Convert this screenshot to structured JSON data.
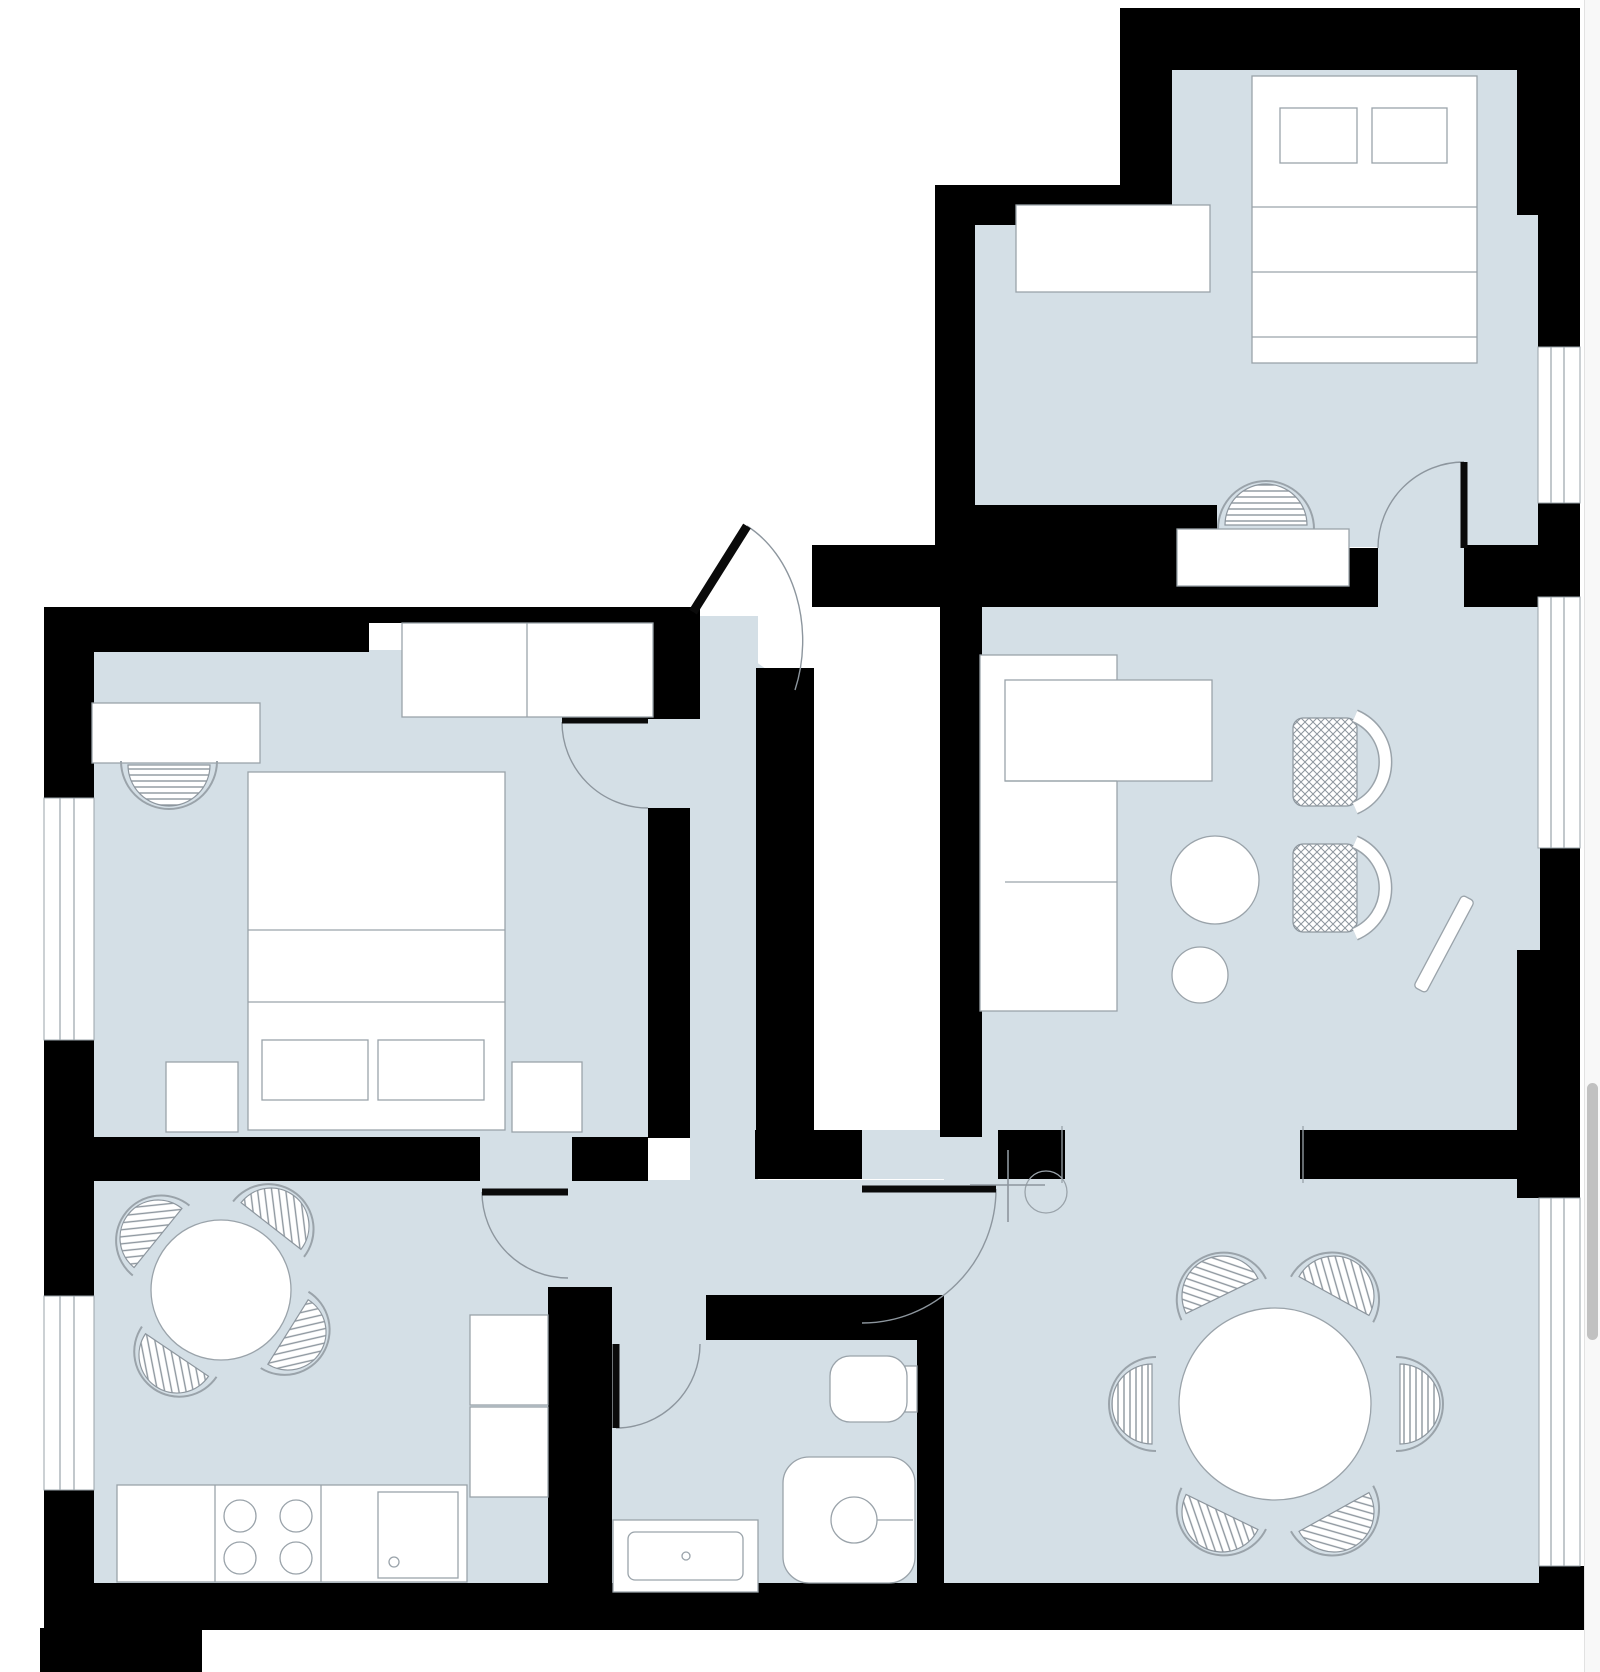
{
  "meta": {
    "title": "apartment-floor-plan",
    "canvas": {
      "width": 1600,
      "height": 1672
    }
  },
  "colors": {
    "wall": "#000000",
    "floor": "#d4dfe6",
    "furniture_fill": "#ffffff",
    "furniture_stroke": "#9aa3aa",
    "hatch": "#8d969e",
    "arc": "#8d969e",
    "leaf": "#0a0a0a",
    "glass_line": "#9aa3aa",
    "scroll_track": "#f8f8f8",
    "scroll_thumb": "#c1c1c1"
  },
  "scrollbar": {
    "thumb_top": 1083,
    "thumb_height": 257
  },
  "floors": [
    {
      "name": "floor-bedroom2-upper",
      "x": 1172,
      "y": 70,
      "w": 345,
      "h": 158
    },
    {
      "name": "floor-bedroom2-right-strip",
      "x": 1517,
      "y": 212,
      "w": 21,
      "h": 135
    },
    {
      "name": "floor-bedroom2-main",
      "x": 975,
      "y": 223,
      "w": 563,
      "h": 284
    },
    {
      "name": "floor-bedroom2-lower-strip",
      "x": 1215,
      "y": 505,
      "w": 323,
      "h": 42
    },
    {
      "name": "floor-bedroom2-door-gap",
      "x": 1378,
      "y": 545,
      "w": 88,
      "h": 62
    },
    {
      "name": "floor-living-notch",
      "x": 940,
      "y": 560,
      "w": 62,
      "h": 46
    },
    {
      "name": "floor-living-room",
      "x": 980,
      "y": 605,
      "w": 560,
      "h": 527
    },
    {
      "name": "floor-living-dining-opening",
      "x": 1065,
      "y": 1130,
      "w": 235,
      "h": 49
    },
    {
      "name": "floor-dining-door-gap",
      "x": 860,
      "y": 1130,
      "w": 140,
      "h": 49
    },
    {
      "name": "floor-dining-room",
      "x": 944,
      "y": 1177,
      "w": 596,
      "h": 407
    },
    {
      "name": "floor-hallway",
      "x": 690,
      "y": 616,
      "w": 68,
      "h": 679
    },
    {
      "name": "floor-hall-lower",
      "x": 552,
      "y": 1180,
      "w": 392,
      "h": 161
    },
    {
      "name": "floor-kitchen",
      "x": 94,
      "y": 1180,
      "w": 458,
      "h": 404
    },
    {
      "name": "floor-bedroom1",
      "x": 94,
      "y": 650,
      "w": 556,
      "h": 488
    },
    {
      "name": "floor-bathroom",
      "x": 612,
      "y": 1340,
      "w": 305,
      "h": 244
    },
    {
      "name": "floor-kitchen-door-gap",
      "x": 480,
      "y": 1137,
      "w": 92,
      "h": 44
    },
    {
      "name": "floor-bedroom1-door-gap",
      "x": 648,
      "y": 719,
      "w": 42,
      "h": 90
    }
  ],
  "floor_polygons": [
    {
      "name": "floor-entry-triangle",
      "points": "690,614 795,690 690,690"
    }
  ],
  "walls": [
    {
      "name": "wall-top",
      "x": 1120,
      "y": 8,
      "w": 460,
      "h": 62
    },
    {
      "name": "wall-bedroom2-left-upper",
      "x": 1120,
      "y": 8,
      "w": 52,
      "h": 180
    },
    {
      "name": "wall-bedroom2-step",
      "x": 935,
      "y": 185,
      "w": 237,
      "h": 40
    },
    {
      "name": "wall-bedroom2-left",
      "x": 935,
      "y": 185,
      "w": 40,
      "h": 360
    },
    {
      "name": "wall-bedroom2-bottom",
      "x": 935,
      "y": 505,
      "w": 282,
      "h": 48
    },
    {
      "name": "wall-entry-top",
      "x": 812,
      "y": 545,
      "w": 132,
      "h": 62
    },
    {
      "name": "wall-living-top",
      "x": 942,
      "y": 548,
      "w": 436,
      "h": 59
    },
    {
      "name": "wall-living-top-stub",
      "x": 1464,
      "y": 545,
      "w": 76,
      "h": 62
    },
    {
      "name": "wall-living-left",
      "x": 940,
      "y": 605,
      "w": 42,
      "h": 532
    },
    {
      "name": "wall-entry-right",
      "x": 756,
      "y": 668,
      "w": 58,
      "h": 469
    },
    {
      "name": "wall-right-top-corner",
      "x": 1517,
      "y": 70,
      "w": 63,
      "h": 145
    },
    {
      "name": "wall-right-1",
      "x": 1538,
      "y": 215,
      "w": 42,
      "h": 132
    },
    {
      "name": "wall-right-2",
      "x": 1538,
      "y": 503,
      "w": 42,
      "h": 94
    },
    {
      "name": "wall-right-3",
      "x": 1540,
      "y": 848,
      "w": 40,
      "h": 104
    },
    {
      "name": "wall-right-pillar",
      "x": 1517,
      "y": 950,
      "w": 63,
      "h": 248
    },
    {
      "name": "wall-bottom-right-corner",
      "x": 1539,
      "y": 1566,
      "w": 45,
      "h": 64
    },
    {
      "name": "wall-dining-top-left",
      "x": 755,
      "y": 1130,
      "w": 107,
      "h": 49
    },
    {
      "name": "wall-dining-top-mid",
      "x": 998,
      "y": 1130,
      "w": 67,
      "h": 49
    },
    {
      "name": "wall-dining-top-right",
      "x": 1300,
      "y": 1130,
      "w": 240,
      "h": 49
    },
    {
      "name": "wall-bedroom1-top",
      "x": 44,
      "y": 607,
      "w": 325,
      "h": 45
    },
    {
      "name": "wall-wardrobe-back",
      "x": 367,
      "y": 607,
      "w": 286,
      "h": 16
    },
    {
      "name": "wall-bedroom1-door-block",
      "x": 648,
      "y": 607,
      "w": 52,
      "h": 112
    },
    {
      "name": "wall-bedroom1-right",
      "x": 648,
      "y": 808,
      "w": 42,
      "h": 330
    },
    {
      "name": "wall-left-upper",
      "x": 44,
      "y": 607,
      "w": 50,
      "h": 191
    },
    {
      "name": "wall-left-mid",
      "x": 44,
      "y": 1040,
      "w": 50,
      "h": 256
    },
    {
      "name": "wall-left-lower",
      "x": 44,
      "y": 1490,
      "w": 50,
      "h": 140
    },
    {
      "name": "wall-bedroom1-kitchen-a",
      "x": 44,
      "y": 1137,
      "w": 436,
      "h": 44
    },
    {
      "name": "wall-bedroom1-kitchen-b",
      "x": 572,
      "y": 1137,
      "w": 76,
      "h": 44
    },
    {
      "name": "wall-kitchen-bath",
      "x": 548,
      "y": 1287,
      "w": 64,
      "h": 343
    },
    {
      "name": "wall-bath-top",
      "x": 706,
      "y": 1295,
      "w": 211,
      "h": 45
    },
    {
      "name": "wall-bath-right",
      "x": 917,
      "y": 1295,
      "w": 27,
      "h": 335
    },
    {
      "name": "wall-bottom",
      "x": 44,
      "y": 1583,
      "w": 1536,
      "h": 47
    },
    {
      "name": "wall-bottom-left-step",
      "x": 40,
      "y": 1628,
      "w": 162,
      "h": 44
    }
  ],
  "windows": [
    {
      "name": "window-bedroom1",
      "x": 44,
      "y": 798,
      "w": 50,
      "h": 242,
      "lines_x": [
        60,
        74
      ]
    },
    {
      "name": "window-kitchen",
      "x": 44,
      "y": 1296,
      "w": 50,
      "h": 194,
      "lines_x": [
        60,
        74
      ]
    },
    {
      "name": "window-bedroom2",
      "x": 1538,
      "y": 347,
      "w": 42,
      "h": 156,
      "lines_x": [
        1551,
        1564
      ]
    },
    {
      "name": "window-living",
      "x": 1538,
      "y": 597,
      "w": 42,
      "h": 251,
      "lines_x": [
        1551,
        1564
      ]
    },
    {
      "name": "window-dining",
      "x": 1539,
      "y": 1198,
      "w": 41,
      "h": 368,
      "lines_x": [
        1551,
        1564
      ]
    }
  ],
  "furniture_rects": [
    {
      "name": "wardrobe-bedroom1",
      "x": 402,
      "y": 623,
      "w": 251,
      "h": 94
    },
    {
      "name": "desk-bedroom1",
      "x": 92,
      "y": 703,
      "w": 168,
      "h": 60
    },
    {
      "name": "bed-bedroom1",
      "x": 248,
      "y": 772,
      "w": 257,
      "h": 358
    },
    {
      "name": "pillow-bedroom1-a",
      "x": 262,
      "y": 1040,
      "w": 106,
      "h": 60
    },
    {
      "name": "pillow-bedroom1-b",
      "x": 378,
      "y": 1040,
      "w": 106,
      "h": 60
    },
    {
      "name": "nightstand-left",
      "x": 166,
      "y": 1062,
      "w": 72,
      "h": 70
    },
    {
      "name": "nightstand-right",
      "x": 512,
      "y": 1062,
      "w": 70,
      "h": 70
    },
    {
      "name": "wardrobe-bedroom2",
      "x": 1016,
      "y": 205,
      "w": 194,
      "h": 87
    },
    {
      "name": "bed-bedroom2",
      "x": 1252,
      "y": 76,
      "w": 225,
      "h": 287
    },
    {
      "name": "pillow-bedroom2-a",
      "x": 1280,
      "y": 108,
      "w": 77,
      "h": 55
    },
    {
      "name": "pillow-bedroom2-b",
      "x": 1372,
      "y": 108,
      "w": 75,
      "h": 55
    },
    {
      "name": "desk-bedroom2",
      "x": 1177,
      "y": 529,
      "w": 172,
      "h": 57
    },
    {
      "name": "sofa-body",
      "x": 980,
      "y": 655,
      "w": 137,
      "h": 356
    },
    {
      "name": "sofa-chaise",
      "x": 1005,
      "y": 680,
      "w": 207,
      "h": 101
    },
    {
      "name": "kitchen-counter",
      "x": 117,
      "y": 1485,
      "w": 350,
      "h": 97
    },
    {
      "name": "kitchen-appliance",
      "x": 378,
      "y": 1492,
      "w": 80,
      "h": 86
    },
    {
      "name": "kitchen-unit-a",
      "x": 470,
      "y": 1315,
      "w": 78,
      "h": 90
    },
    {
      "name": "kitchen-unit-b",
      "x": 470,
      "y": 1407,
      "w": 78,
      "h": 90
    },
    {
      "name": "toilet-tank",
      "x": 905,
      "y": 1366,
      "w": 12,
      "h": 46
    },
    {
      "name": "sink-bathroom",
      "x": 613,
      "y": 1520,
      "w": 145,
      "h": 72
    }
  ],
  "furniture_round_rects": [
    {
      "name": "toilet-bowl",
      "x": 830,
      "y": 1356,
      "w": 77,
      "h": 66,
      "rx": 20
    },
    {
      "name": "shower-tray",
      "x": 783,
      "y": 1457,
      "w": 132,
      "h": 126,
      "rx": 26
    },
    {
      "name": "sink-basin",
      "x": 628,
      "y": 1532,
      "w": 115,
      "h": 48,
      "rx": 7
    }
  ],
  "furniture_circles": [
    {
      "name": "coffee-table-large",
      "cx": 1215,
      "cy": 880,
      "r": 44,
      "fill": true
    },
    {
      "name": "coffee-table-small",
      "cx": 1200,
      "cy": 975,
      "r": 28,
      "fill": true
    },
    {
      "name": "kitchen-table",
      "cx": 221,
      "cy": 1290,
      "r": 70,
      "fill": true
    },
    {
      "name": "dining-table",
      "cx": 1275,
      "cy": 1404,
      "r": 96,
      "fill": true
    },
    {
      "name": "stove-burner-1",
      "cx": 240,
      "cy": 1516,
      "r": 16,
      "fill": false
    },
    {
      "name": "stove-burner-2",
      "cx": 296,
      "cy": 1516,
      "r": 16,
      "fill": false
    },
    {
      "name": "stove-burner-3",
      "cx": 240,
      "cy": 1558,
      "r": 16,
      "fill": false
    },
    {
      "name": "stove-burner-4",
      "cx": 296,
      "cy": 1558,
      "r": 16,
      "fill": false
    },
    {
      "name": "appliance-knob",
      "cx": 394,
      "cy": 1562,
      "r": 5,
      "fill": false
    },
    {
      "name": "shower-drain",
      "cx": 854,
      "cy": 1520,
      "r": 23,
      "fill": false
    },
    {
      "name": "sink-faucet-dot",
      "cx": 686,
      "cy": 1556,
      "r": 4,
      "fill": false
    },
    {
      "name": "lamp-shade",
      "cx": 1046,
      "cy": 1192,
      "r": 21,
      "fill": false
    }
  ],
  "detail_lines": [
    {
      "name": "bed1-fold-1",
      "x1": 248,
      "y1": 930,
      "x2": 505,
      "y2": 930
    },
    {
      "name": "bed1-fold-2",
      "x1": 248,
      "y1": 1002,
      "x2": 505,
      "y2": 1002
    },
    {
      "name": "wardrobe1-divider",
      "x1": 527,
      "y1": 623,
      "x2": 527,
      "y2": 717
    },
    {
      "name": "bed2-fold-1",
      "x1": 1252,
      "y1": 207,
      "x2": 1477,
      "y2": 207
    },
    {
      "name": "bed2-fold-2",
      "x1": 1252,
      "y1": 272,
      "x2": 1477,
      "y2": 272
    },
    {
      "name": "bed2-fold-3",
      "x1": 1252,
      "y1": 337,
      "x2": 1477,
      "y2": 337
    },
    {
      "name": "sofa-seam-1",
      "x1": 1005,
      "y1": 781,
      "x2": 1117,
      "y2": 781
    },
    {
      "name": "sofa-seam-2",
      "x1": 1005,
      "y1": 882,
      "x2": 1117,
      "y2": 882
    },
    {
      "name": "counter-divider-1",
      "x1": 215,
      "y1": 1485,
      "x2": 215,
      "y2": 1582
    },
    {
      "name": "counter-divider-2",
      "x1": 321,
      "y1": 1485,
      "x2": 321,
      "y2": 1582
    },
    {
      "name": "opening-jamb-left",
      "x1": 1062,
      "y1": 1126,
      "x2": 1062,
      "y2": 1183
    },
    {
      "name": "opening-jamb-right",
      "x1": 1303,
      "y1": 1126,
      "x2": 1303,
      "y2": 1183
    },
    {
      "name": "shower-handle",
      "x1": 877,
      "y1": 1520,
      "x2": 913,
      "y2": 1520
    }
  ],
  "lamp_lines": [
    {
      "name": "lamp-arm-h",
      "x1": 970,
      "y1": 1185,
      "x2": 1045,
      "y2": 1185
    },
    {
      "name": "lamp-arm-v",
      "x1": 1008,
      "y1": 1150,
      "x2": 1008,
      "y2": 1222
    }
  ],
  "mirror": {
    "name": "mirror-leaning",
    "cx": 1444,
    "cy": 944,
    "length": 104,
    "width": 14,
    "angle": -62
  },
  "chairs": [
    {
      "name": "desk-chair-bedroom1",
      "cx": 169,
      "cy": 765,
      "r": 41,
      "rot": 180,
      "pattern": "stripe"
    },
    {
      "name": "desk-chair-bedroom2",
      "cx": 1266,
      "cy": 525,
      "r": 41,
      "rot": 0,
      "pattern": "stripe"
    },
    {
      "name": "dining-chair-1",
      "cx": 1222,
      "cy": 1296,
      "r": 40,
      "rot": -26,
      "pattern": "diag"
    },
    {
      "name": "dining-chair-2",
      "cx": 1334,
      "cy": 1296,
      "r": 40,
      "rot": 29,
      "pattern": "diag"
    },
    {
      "name": "dining-chair-3",
      "cx": 1152,
      "cy": 1404,
      "r": 40,
      "rot": 270,
      "pattern": "stripe"
    },
    {
      "name": "dining-chair-4",
      "cx": 1400,
      "cy": 1404,
      "r": 40,
      "rot": 90,
      "pattern": "stripe"
    },
    {
      "name": "dining-chair-5",
      "cx": 1222,
      "cy": 1512,
      "r": 40,
      "rot": 206,
      "pattern": "diag"
    },
    {
      "name": "dining-chair-6",
      "cx": 1334,
      "cy": 1512,
      "r": 40,
      "rot": 151,
      "pattern": "diag"
    },
    {
      "name": "kitchen-chair-1",
      "cx": 271,
      "cy": 1226,
      "r": 38,
      "rot": 38,
      "pattern": "diag"
    },
    {
      "name": "kitchen-chair-2",
      "cx": 158,
      "cy": 1238,
      "r": 38,
      "rot": -51,
      "pattern": "diag"
    },
    {
      "name": "kitchen-chair-3",
      "cx": 177,
      "cy": 1355,
      "r": 38,
      "rot": 214,
      "pattern": "diag"
    },
    {
      "name": "kitchen-chair-4",
      "cx": 288,
      "cy": 1332,
      "r": 38,
      "rot": 122,
      "pattern": "diag"
    }
  ],
  "armchairs": [
    {
      "name": "armchair-1",
      "cx": 1337,
      "cy": 762
    },
    {
      "name": "armchair-2",
      "cx": 1337,
      "cy": 888
    }
  ],
  "door_arcs": [
    {
      "name": "arc-entry-door",
      "d": "M 747,526 A 100,128 0 0 1 795,690"
    },
    {
      "name": "arc-bedroom1-door",
      "d": "M 562,722 A 86,86 0 0 0 648,808"
    },
    {
      "name": "arc-bedroom2-door",
      "d": "M 1464,462 A 86,86 0 0 0 1378,548"
    },
    {
      "name": "arc-kitchen-door",
      "d": "M 482,1192 A 86,86 0 0 0 568,1278"
    },
    {
      "name": "arc-dining-door",
      "d": "M 996,1189 A 134,134 0 0 1 862,1323"
    },
    {
      "name": "arc-bathroom-door",
      "d": "M 616,1428 A 84,84 0 0 0 700,1344"
    }
  ],
  "door_leaves": [
    {
      "name": "leaf-entry-door",
      "x1": 693,
      "y1": 612,
      "x2": 747,
      "y2": 526,
      "w": 9
    },
    {
      "name": "leaf-bedroom1-door",
      "x1": 562,
      "y1": 720,
      "x2": 648,
      "y2": 720,
      "w": 7
    },
    {
      "name": "leaf-bedroom2-door",
      "x1": 1464,
      "y1": 462,
      "x2": 1464,
      "y2": 548,
      "w": 7
    },
    {
      "name": "leaf-kitchen-door",
      "x1": 482,
      "y1": 1192,
      "x2": 568,
      "y2": 1192,
      "w": 7
    },
    {
      "name": "leaf-dining-door",
      "x1": 862,
      "y1": 1189,
      "x2": 996,
      "y2": 1189,
      "w": 7
    },
    {
      "name": "leaf-bathroom-door",
      "x1": 616,
      "y1": 1344,
      "x2": 616,
      "y2": 1428,
      "w": 7
    }
  ]
}
